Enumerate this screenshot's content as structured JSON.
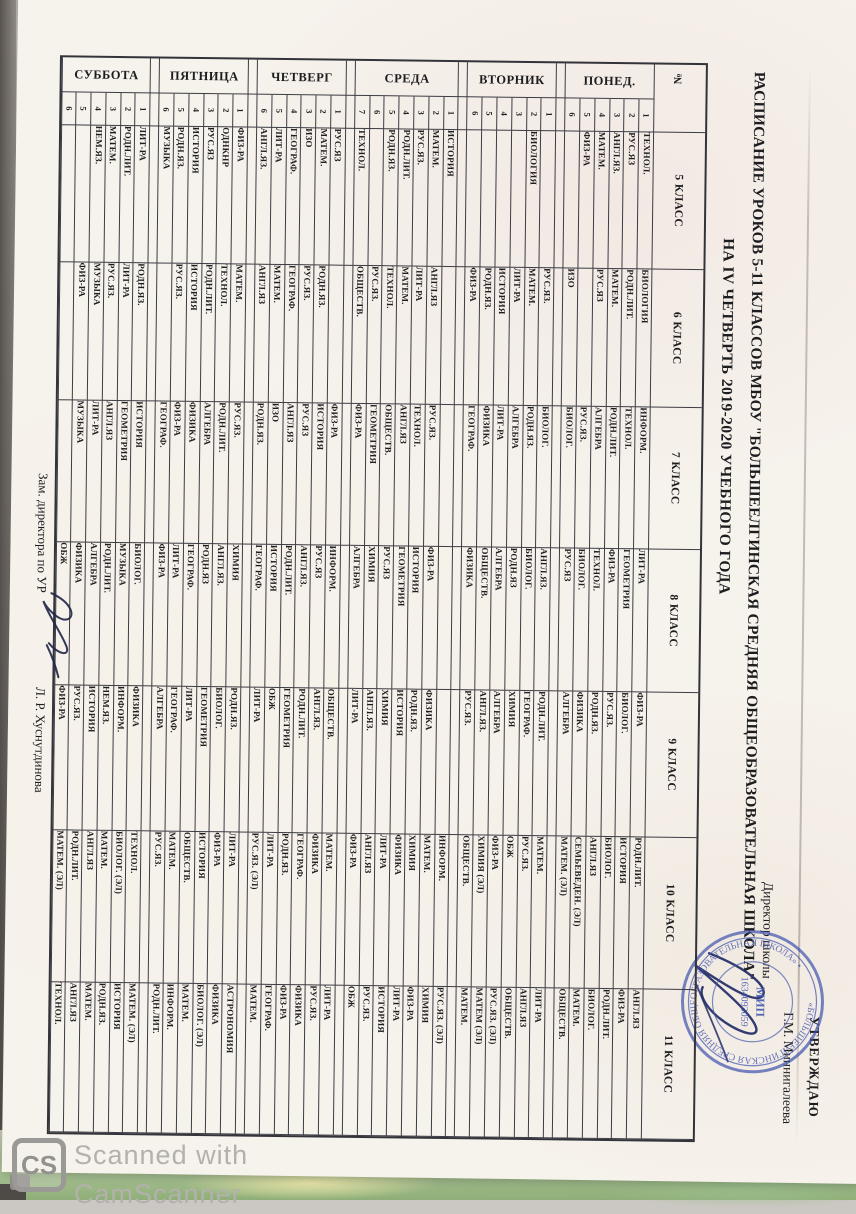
{
  "scan": {
    "logo_letters": "CS",
    "footer_line1": "Scanned with",
    "footer_line2": "CamScanner"
  },
  "document": {
    "approval": {
      "line1": "УТВЕРЖДАЮ",
      "line2": "Директор школы",
      "name": "Г.М. Миннигалеева"
    },
    "title_line1": "РАСПИСАНИЕ УРОКОВ 5-11 КЛАССОВ МБОУ \"БОЛЬШЕЕЛГИНСКАЯ СРЕДНЯЯ ОБЩЕОБРАЗОВАТЕЛЬНАЯ ШКОЛА\"",
    "title_line2": "НА IV ЧЕТВЕРТЬ 2019-2020 УЧЕБНОГО ГОДА",
    "deputy_label": "Зам. директора по УР",
    "deputy_name": "Л. Р. Хуснутдинова",
    "stamp": {
      "ring_text": "«БОЛЬШЕЕЛГИНСКАЯ СРЕДНЯЯ ОБЩЕОБРАЗОВАТЕЛЬНАЯ ШКОЛА» •",
      "center_line1": "МИП",
      "center_line2": "1634093059",
      "color": "#4053ae"
    },
    "table": {
      "corner_header": "№",
      "class_headers": [
        "5 КЛАСС",
        "6 КЛАСС",
        "7 КЛАСС",
        "8 КЛАСС",
        "9 КЛАСС",
        "10 КЛАСС",
        "11 КЛАСС"
      ],
      "days": [
        {
          "name": "ПОНЕД.",
          "rows": [
            {
              "n": "1",
              "s": [
                "ТЕХНОЛ.",
                "БИОЛОГИЯ",
                "ИНФОРМ.",
                "ЛИТ-РА",
                "ФИЗ-РА",
                "РОДН.ЛИТ.",
                "АНГЛ.ЯЗ"
              ]
            },
            {
              "n": "2",
              "s": [
                "РУС.ЯЗ",
                "РОДН.ЛИТ.",
                "ТЕХНОЛ.",
                "ГЕОМЕТРИЯ",
                "БИОЛОГ.",
                "ИСТОРИЯ",
                "ФИЗ-РА"
              ]
            },
            {
              "n": "3",
              "s": [
                "АНГЛ.ЯЗ.",
                "МАТЕМ.",
                "РОДН.ЛИТ.",
                "ФИЗ-РА",
                "РУС.ЯЗ.",
                "БИОЛОГ.",
                "РОДН.ЛИТ."
              ]
            },
            {
              "n": "4",
              "s": [
                "МАТЕМ.",
                "РУС.ЯЗ",
                "АЛГЕБРА",
                "ТЕХНОЛ.",
                "РОДН.ЯЗ.",
                "АНГЛ.ЯЗ",
                "БИОЛОГ."
              ]
            },
            {
              "n": "5",
              "s": [
                "ФИЗ-РА",
                "",
                "РУС.ЯЗ.",
                "БИОЛОГ.",
                "ФИЗИКА",
                "СЕМЬЕВЕДЕН. (ЭЛ)",
                "МАТЕМ."
              ]
            },
            {
              "n": "6",
              "s": [
                "",
                "ИЗО",
                "БИОЛОГ.",
                "РУС.ЯЗ",
                "АЛГЕБРА",
                "МАТЕМ. (ЭЛ)",
                "ОБЩЕСТВ."
              ]
            }
          ]
        },
        {
          "name": "ВТОРНИК",
          "rows": [
            {
              "n": "1",
              "s": [
                "",
                "РУС.ЯЗ.",
                "БИОЛОГ.",
                "АНГЛ.ЯЗ.",
                "РОДН.ЛИТ.",
                "МАТЕМ.",
                "ЛИТ-РА"
              ]
            },
            {
              "n": "2",
              "s": [
                "БИОЛОГИЯ",
                "МАТЕМ.",
                "РОДН.ЯЗ.",
                "БИОЛОГ.",
                "ГЕОГРАФ.",
                "РУС.ЯЗ.",
                "АНГЛ.ЯЗ"
              ]
            },
            {
              "n": "3",
              "s": [
                "",
                "ЛИТ-РА",
                "АЛГЕБРА",
                "РОДН.ЯЗ",
                "ХИМИЯ",
                "ОБЖ",
                "ОБЩЕСТВ."
              ]
            },
            {
              "n": "4",
              "s": [
                "",
                "ИСТОРИЯ",
                "ЛИТ-РА",
                "АЛГЕБРА",
                "АЛГЕБРА",
                "ФИЗ-РА",
                "РУС.ЯЗ. (ЭЛ)"
              ]
            },
            {
              "n": "5",
              "s": [
                "",
                "РОДН.ЯЗ.",
                "ФИЗИКА",
                "ОБЩЕСТВ.",
                "АНГЛ.ЯЗ.",
                "ХИМИЯ (ЭЛ)",
                "МАТЕМ (ЭЛ)"
              ]
            },
            {
              "n": "6",
              "s": [
                "",
                "ФИЗ-РА",
                "ГЕОГРАФ.",
                "ФИЗИКА",
                "РУС.ЯЗ.",
                "ОБЩЕСТВ.",
                "МАТЕМ."
              ]
            }
          ]
        },
        {
          "name": "СРЕДА",
          "rows": [
            {
              "n": "1",
              "s": [
                "ИСТОРИЯ",
                "",
                "",
                "",
                "",
                "ИНФОРМ.",
                "РУС.ЯЗ. (ЭЛ)"
              ]
            },
            {
              "n": "2",
              "s": [
                "МАТЕМ.",
                "АНГЛ.ЯЗ",
                "РУС.ЯЗ.",
                "ФИЗ-РА",
                "ФИЗИКА",
                "МАТЕМ.",
                "ХИМИЯ"
              ]
            },
            {
              "n": "3",
              "s": [
                "РУС.ЯЗ.",
                "ЛИТ-РА",
                "ТЕХНОЛ.",
                "ИСТОРИЯ",
                "РОДН.ЯЗ.",
                "ХИМИЯ",
                "ФИЗ-РА"
              ]
            },
            {
              "n": "4",
              "s": [
                "РОДН.ЛИТ.",
                "МАТЕМ.",
                "АНГЛ.ЯЗ",
                "ГЕОМЕТРИЯ",
                "ИСТОРИЯ",
                "ФИЗИКА",
                "ЛИТ-РА"
              ]
            },
            {
              "n": "5",
              "s": [
                "РОДН.ЯЗ.",
                "ТЕХНОЛ.",
                "ОБЩЕСТВ.",
                "РУС.ЯЗ",
                "ХИМИЯ",
                "ЛИТ-РА",
                "ИСТОРИЯ"
              ]
            },
            {
              "n": "6",
              "s": [
                "",
                "РУС.ЯЗ.",
                "ГЕОМЕТРИЯ",
                "ХИМИЯ",
                "АНГЛ.ЯЗ.",
                "АНГЛ.ЯЗ",
                "РУС.ЯЗ."
              ]
            },
            {
              "n": "7",
              "s": [
                "ТЕХНОЛ.",
                "ОБЩЕСТВ.",
                "ФИЗ-РА",
                "АЛГЕБРА",
                "ЛИТ-РА",
                "ФИЗ-РА",
                "ОБЖ"
              ]
            }
          ]
        },
        {
          "name": "ЧЕТВЕРГ",
          "rows": [
            {
              "n": "1",
              "s": [
                "РУС.ЯЗ",
                "",
                "ФИЗ-РА",
                "ИНФОРМ.",
                "ОБЩЕСТВ.",
                "МАТЕМ.",
                "ЛИТ-РА"
              ]
            },
            {
              "n": "2",
              "s": [
                "МАТЕМ.",
                "РОДН.ЯЗ.",
                "ИСТОРИЯ",
                "РУС.ЯЗ",
                "АНГЛ.ЯЗ.",
                "ФИЗИКА",
                "РУС.ЯЗ."
              ]
            },
            {
              "n": "3",
              "s": [
                "ИЗО",
                "РУС.ЯЗ.",
                "РУС.ЯЗ",
                "АНГЛ.ЯЗ.",
                "РОДН.ЛИТ.",
                "ГЕОГРАФ.",
                "ФИЗИКА"
              ]
            },
            {
              "n": "4",
              "s": [
                "ГЕОГРАФ.",
                "ГЕОГРАФ.",
                "АНГЛ.ЯЗ",
                "РОДН.ЛИТ.",
                "ГЕОМЕТРИЯ",
                "РОДН.ЯЗ.",
                "ФИЗ-РА"
              ]
            },
            {
              "n": "5",
              "s": [
                "ЛИТ-РА",
                "МАТЕМ.",
                "ИЗО",
                "ИСТОРИЯ",
                "ОБЖ",
                "ЛИТ-РА",
                "ГЕОГРАФ."
              ]
            },
            {
              "n": "6",
              "s": [
                "АНГЛ.ЯЗ.",
                "АНГЛ.ЯЗ",
                "РОДН.ЯЗ.",
                "ГЕОГРАФ.",
                "ЛИТ-РА",
                "РУС.ЯЗ. (ЭЛ)",
                "МАТЕМ."
              ]
            }
          ]
        },
        {
          "name": "ПЯТНИЦА",
          "rows": [
            {
              "n": "1",
              "s": [
                "ФИЗ-РА",
                "МАТЕМ.",
                "РУС.ЯЗ.",
                "ХИМИЯ",
                "РОДН.ЯЗ.",
                "ЛИТ-РА",
                "АСТРОНОМИЯ"
              ]
            },
            {
              "n": "2",
              "s": [
                "ОДНКНР",
                "ТЕХНОЛ.",
                "РОДН.ЛИТ.",
                "АНГЛ.ЯЗ.",
                "БИОЛОГ.",
                "ФИЗ-РА",
                "ФИЗИКА"
              ]
            },
            {
              "n": "3",
              "s": [
                "РУС.ЯЗ",
                "РОДН.ЛИТ.",
                "АЛГЕБРА",
                "РОДН.ЯЗ",
                "ГЕОМЕТРИЯ",
                "ИСТОРИЯ",
                "БИОЛОГ. (ЭЛ)"
              ]
            },
            {
              "n": "4",
              "s": [
                "ИСТОРИЯ",
                "ИСТОРИЯ",
                "ФИЗИКА",
                "ГЕОГРАФ.",
                "ЛИТ-РА",
                "ОБЩЕСТВ.",
                "МАТЕМ."
              ]
            },
            {
              "n": "5",
              "s": [
                "РОДН.ЯЗ.",
                "РУС.ЯЗ.",
                "ФИЗ-РА",
                "ЛИТ-РА",
                "ГЕОГРАФ.",
                "МАТЕМ.",
                "ИНФОРМ."
              ]
            },
            {
              "n": "6",
              "s": [
                "МУЗЫКА",
                "",
                "ГЕОГРАФ.",
                "ФИЗ-РА",
                "АЛГЕБРА",
                "РУС.ЯЗ.",
                "РОДН.ЛИТ."
              ]
            }
          ]
        },
        {
          "name": "СУББОТА",
          "rows": [
            {
              "n": "1",
              "s": [
                "ЛИТ-РА",
                "РОДН.ЯЗ.",
                "ИСТОРИЯ",
                "БИОЛОГ.",
                "ФИЗИКА",
                "ТЕХНОЛ.",
                "МАТЕМ. (ЭЛ)"
              ]
            },
            {
              "n": "2",
              "s": [
                "РОДН.ЛИТ.",
                "ЛИТ-РА",
                "ГЕОМЕТРИЯ",
                "МУЗЫКА",
                "ИНФОРМ.",
                "БИОЛОГ. (ЭЛ)",
                "ИСТОРИЯ"
              ]
            },
            {
              "n": "3",
              "s": [
                "МАТЕМ.",
                "РУС.ЯЗ.",
                "АНГЛ.ЯЗ",
                "РОДН.ЛИТ.",
                "НЕМ.ЯЗ.",
                "МАТЕМ.",
                "РОДН.ЯЗ."
              ]
            },
            {
              "n": "4",
              "s": [
                "НЕМ.ЯЗ.",
                "МУЗЫКА",
                "ЛИТ-РА",
                "АЛГЕБРА",
                "ИСТОРИЯ",
                "АНГЛ.ЯЗ",
                "МАТЕМ."
              ]
            },
            {
              "n": "5",
              "s": [
                "",
                "ФИЗ-РА",
                "МУЗЫКА",
                "ФИЗИКА",
                "РУС.ЯЗ.",
                "РОДН.ЛИТ.",
                "АНГЛ.ЯЗ"
              ]
            },
            {
              "n": "6",
              "s": [
                "",
                "",
                "",
                "ОБЖ",
                "ФИЗ-РА",
                "МАТЕМ. (ЭЛ)",
                "ТЕХНОЛ."
              ]
            }
          ]
        }
      ]
    }
  }
}
